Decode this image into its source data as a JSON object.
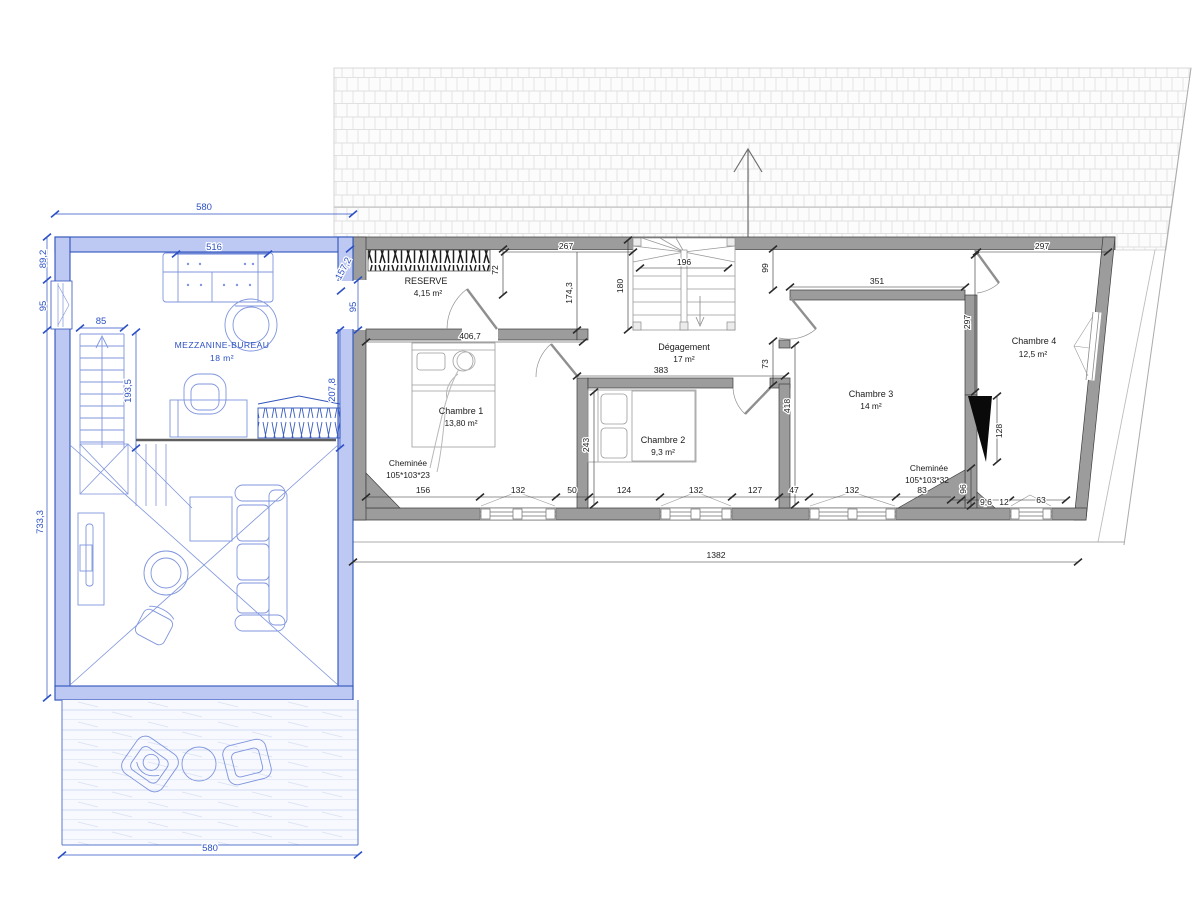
{
  "drawing": {
    "mezzanine": {
      "label": "MEZZANINE-BUREAU",
      "area": "18 m²",
      "dim_width_top": "580",
      "dim_height_top": "89,2",
      "dim_window_left": "95",
      "dim_height_total": "733,3",
      "dim_sofa": "516",
      "dim_diag": "157,2",
      "dim_passage": "95",
      "dim_stair_width": "85",
      "dim_stair_height": "193,5",
      "dim_office_depth": "207,8",
      "dim_terrace_width": "580"
    },
    "rooms": {
      "reserve": {
        "label": "RESERVE",
        "area": "4,15 m²"
      },
      "degagement": {
        "label": "Dégagement",
        "area": "17 m²"
      },
      "chambre1": {
        "label": "Chambre 1",
        "area": "13,80 m²"
      },
      "chambre2": {
        "label": "Chambre 2",
        "area": "9,3 m²"
      },
      "chambre3": {
        "label": "Chambre 3",
        "area": "14 m²"
      },
      "chambre4": {
        "label": "Chambre 4",
        "area": "12,5 m²"
      }
    },
    "fireplaces": {
      "left": {
        "label": "Cheminée",
        "size": "105*103*23"
      },
      "right": {
        "label": "Cheminée",
        "size": "105*103*32"
      }
    },
    "dims": {
      "d72": "72",
      "d267": "267",
      "d174": "174,3",
      "d180": "180",
      "d196": "196",
      "d99": "99",
      "d351": "351",
      "d297h": "297",
      "d297v": "297",
      "d406": "406,7",
      "d383": "383",
      "d73": "73",
      "d418": "418",
      "d243": "243",
      "d128": "128",
      "d96": "96",
      "total": "1382",
      "bottom": [
        "156",
        "132",
        "50",
        "124",
        "132",
        "127",
        "47",
        "132",
        "83",
        "9,6",
        "12",
        "63"
      ]
    }
  }
}
